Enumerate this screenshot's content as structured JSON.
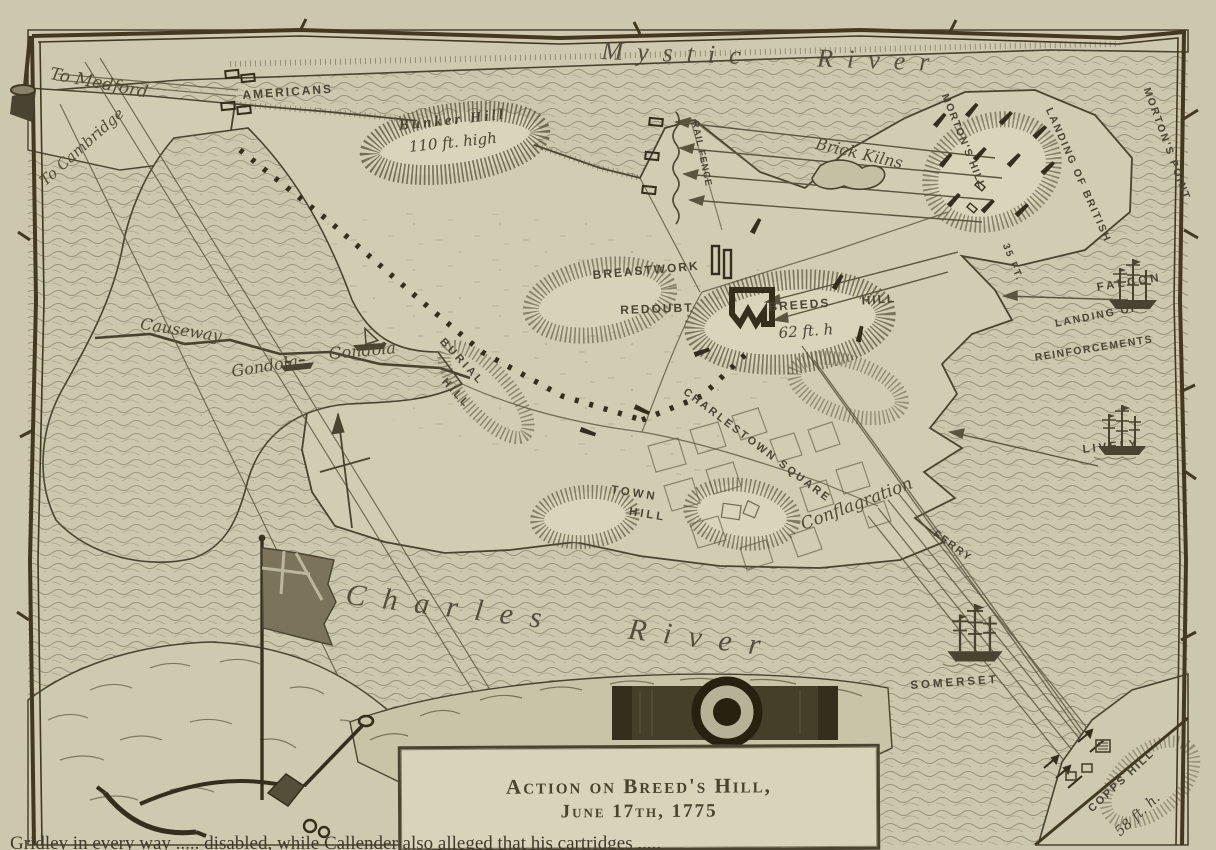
{
  "page": {
    "type": "engraved historical battle map",
    "paper_color": "#cdc7ae",
    "ink_color": "#4a4434",
    "dark_ink_color": "#3a3320"
  },
  "cartouche": {
    "line1": "Action on Breed's Hill,",
    "line2": "June 17th, 1775"
  },
  "caption": "Gridley in every way ..... disabled, while Callender also alleged that his cartridges .....",
  "labels": {
    "mystic_river": {
      "text": "Mystic River"
    },
    "charles_river": {
      "text": "Charles River"
    },
    "to_medford": {
      "text": "To Medford"
    },
    "to_cambridge": {
      "text": "To Cambridge"
    },
    "americans": {
      "text": "Americans"
    },
    "bunker_hill": {
      "text": "Bunker Hill"
    },
    "bunker_hill_height": {
      "text": "110 ft. high"
    },
    "rail_fence": {
      "text": "Rail Fence"
    },
    "brick_kilns": {
      "text": "Brick Kilns"
    },
    "mortons_hill": {
      "text": "Morton's Hill"
    },
    "mortons_hill_height": {
      "text": "35 ft."
    },
    "landing_of_british": {
      "text": "Landing of British"
    },
    "mortons_point": {
      "text": "Morton's Point"
    },
    "breastwork": {
      "text": "Breastwork"
    },
    "redoubt": {
      "text": "Redoubt"
    },
    "breeds_hill": {
      "text": "Breeds Hill"
    },
    "breeds_hill_height": {
      "text": "62 ft. h"
    },
    "falcon": {
      "text": "Falcon"
    },
    "landing_of_reinforcements_1": {
      "text": "Landing of"
    },
    "landing_of_reinforcements_2": {
      "text": "Reinforcements"
    },
    "lively": {
      "text": "Lively"
    },
    "causeway": {
      "text": "Causeway"
    },
    "gondola_1": {
      "text": "Gondola"
    },
    "gondola_2": {
      "text": "Gondola"
    },
    "burial_hill_1": {
      "text": "Burial"
    },
    "burial_hill_2": {
      "text": "Hill"
    },
    "charlestown_square": {
      "text": "Charlestown Square"
    },
    "conflagration": {
      "text": "Conflagration"
    },
    "town_hill_1": {
      "text": "Town"
    },
    "town_hill_2": {
      "text": "Hill"
    },
    "ferry": {
      "text": "Ferry"
    },
    "somerset": {
      "text": "Somerset"
    },
    "copps_hill": {
      "text": "Copps Hill"
    },
    "copps_hill_height": {
      "text": "58 ft. h."
    },
    "icons": {
      "hatchet-icon": "twig-border hatchet, CSS/SVG shape",
      "flag-icon": "british flag on pole, SVG shape",
      "pickaxe-icon": "pickaxe, SVG shape",
      "shovel-icon": "shovel, SVG shape",
      "cannon-icon": "cannon muzzle front view, SVG shape",
      "ship-icon": "three-masted warship, SVG shape",
      "gondola-icon": "small gun barge, SVG shape",
      "north-arrow-icon": "north arrow, SVG shape",
      "redoubt-icon": "black zigzag fort symbol, SVG shape"
    }
  }
}
